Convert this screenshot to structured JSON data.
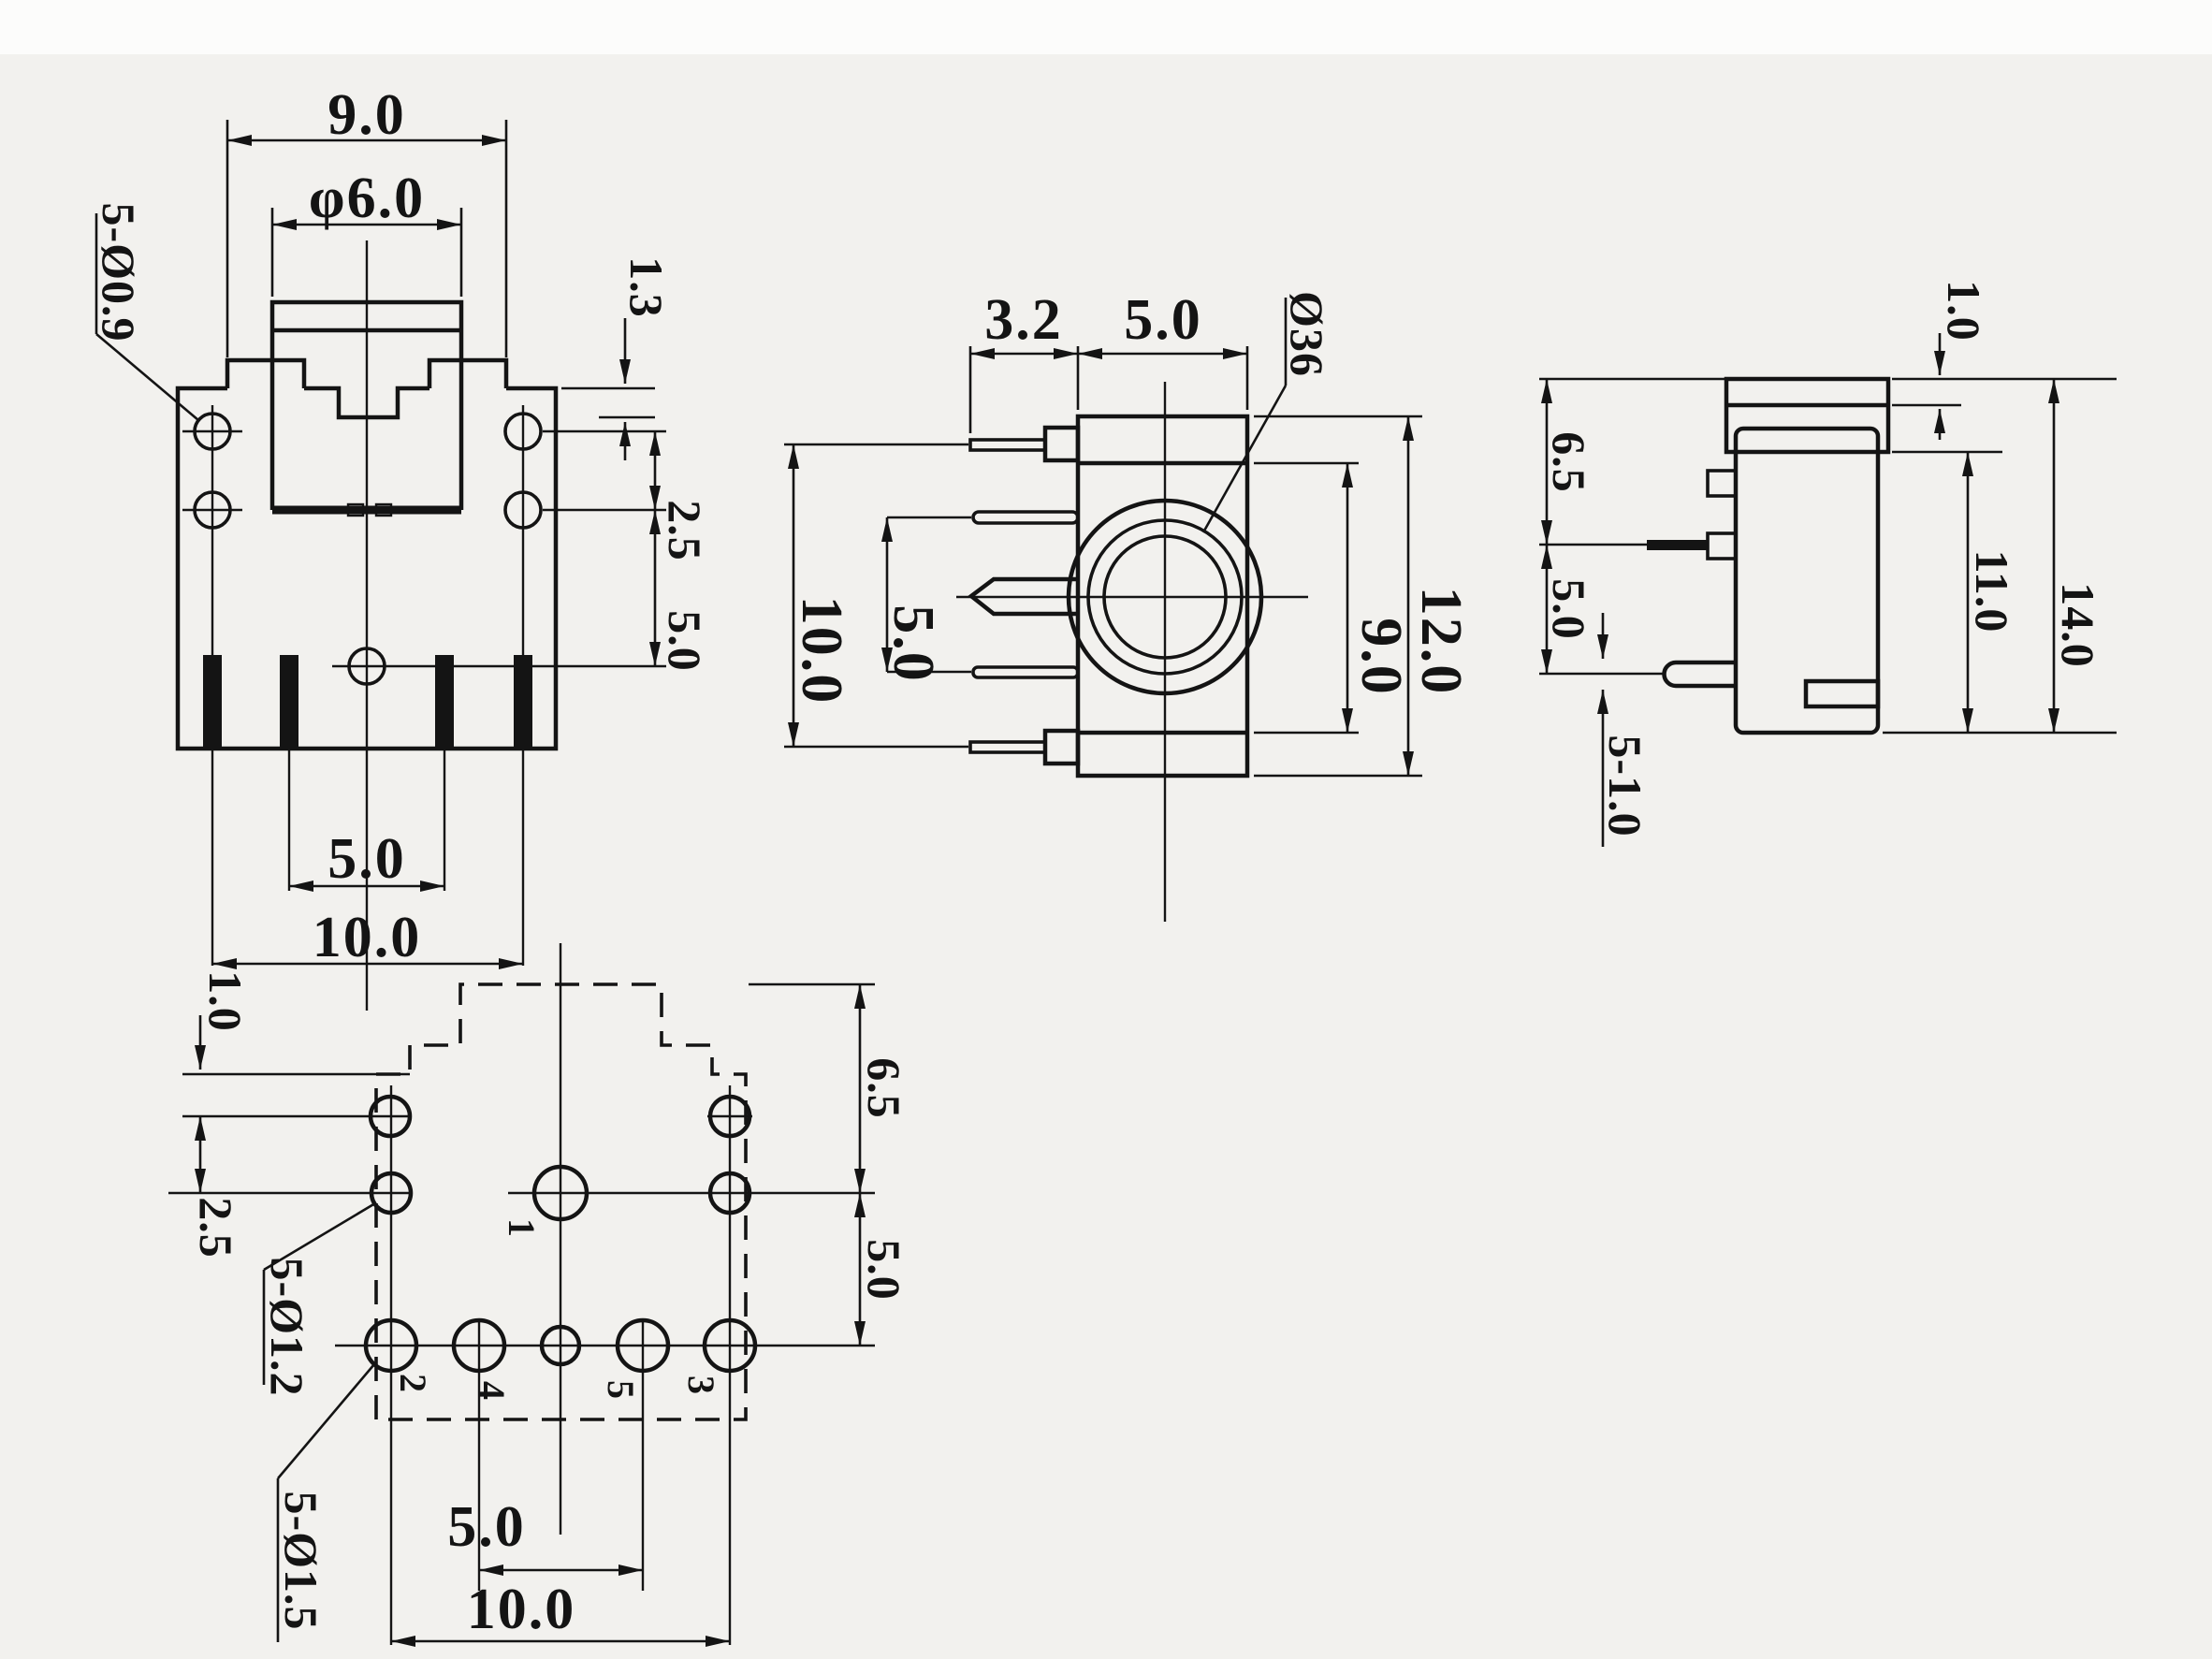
{
  "colors": {
    "line": "#141414",
    "paper": "#f2f1ee"
  },
  "views": {
    "front": {
      "dims": {
        "top_width": "9.0",
        "bushing_dia": "φ6.0",
        "notch_depth": "1.3",
        "hole_row_gap": "2.5",
        "row_to_center": "5.0",
        "pin_pitch_inner": "5.0",
        "pin_pitch_outer": "10.0"
      },
      "labels": {
        "mount_holes": "5-Ø0.9"
      }
    },
    "side": {
      "dims": {
        "pin_length": "3.2",
        "body_width": "5.0",
        "pin_span_inner": "5.0",
        "pin_span_outer": "10.0",
        "frame_height": "9.0",
        "overall_height": "12.0"
      },
      "labels": {
        "bore_dia": "Ø36"
      }
    },
    "end": {
      "dims": {
        "cap_height": "1.0",
        "top_to_pin": "6.5",
        "pin_to_leg": "5.0",
        "body_height": "11.0",
        "overall_height": "14.0"
      },
      "labels": {
        "leg_thickness": "5-1.0"
      }
    },
    "footprint": {
      "dims": {
        "edge_to_row1": "1.0",
        "row1_to_row2": "2.5",
        "top_to_center": "6.5",
        "center_to_row3": "5.0",
        "hole_pitch_inner": "5.0",
        "hole_pitch_outer": "10.0"
      },
      "labels": {
        "small_holes": "5-Ø1.2",
        "large_holes": "5-Ø1.5"
      },
      "pins": {
        "p1": "1",
        "p2": "2",
        "p3": "3",
        "p4": "4",
        "p5": "5"
      }
    }
  }
}
